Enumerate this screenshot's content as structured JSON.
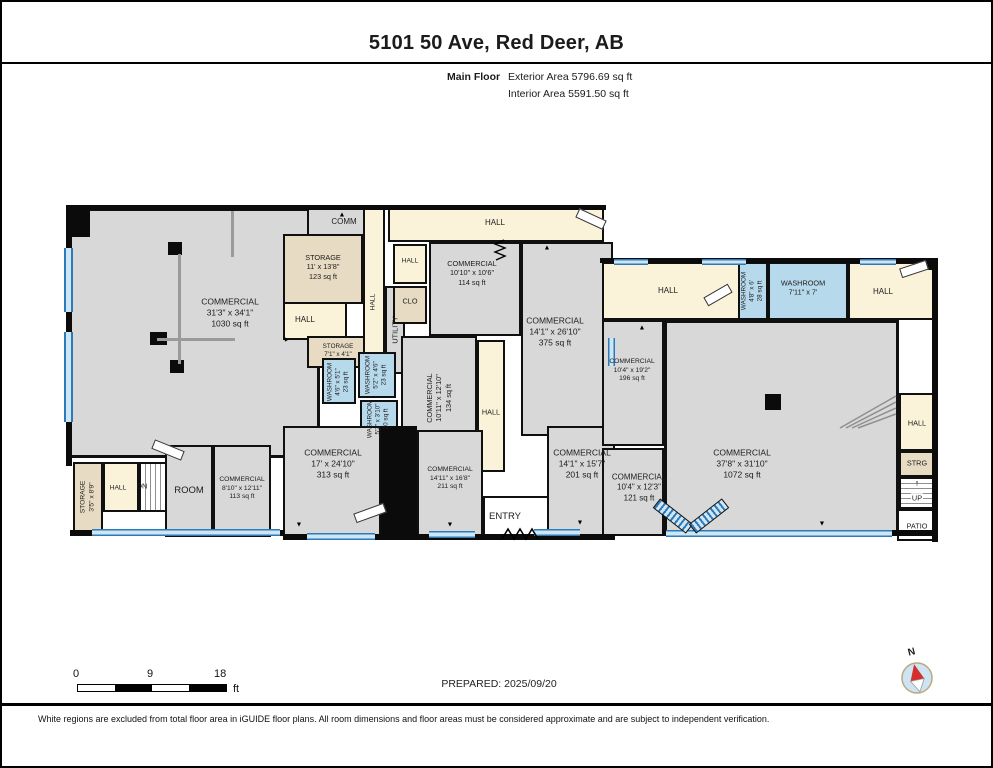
{
  "header": {
    "title": "5101 50 Ave, Red Deer, AB",
    "floor_label": "Main Floor",
    "exterior_area": "Exterior Area 5796.69 sq ft",
    "interior_area": "Interior Area 5591.50 sq ft"
  },
  "rooms": {
    "commercial_1030": {
      "n": "COMMERCIAL",
      "d": "31'3\" x 34'1\"",
      "a": "1030 sq ft"
    },
    "comm": {
      "n": "COMM"
    },
    "storage_123": {
      "n": "STORAGE",
      "d": "11' x 13'8\"",
      "a": "123 sq ft"
    },
    "hall_left": {
      "n": "HALL"
    },
    "storage_small": {
      "n": "STORAGE",
      "d": "7'1\" x 4'1\""
    },
    "hall_vert": {
      "n": "HALL"
    },
    "utility": {
      "n": "UTILITY"
    },
    "hall_top": {
      "n": "HALL"
    },
    "hall_small": {
      "n": "HALL"
    },
    "clo": {
      "n": "CLO"
    },
    "commercial_114": {
      "n": "COMMERCIAL",
      "d": "10'10\" x 10'6\"",
      "a": "114 sq ft"
    },
    "commercial_375": {
      "n": "COMMERCIAL",
      "d": "14'1\" x 26'10\"",
      "a": "375 sq ft"
    },
    "commercial_134": {
      "n": "COMMERCIAL",
      "d": "10'11\" x 12'10\"",
      "a": "134 sq ft"
    },
    "washroom_23a": {
      "n": "WASHROOM",
      "d": "4'6\" x 5'1\"",
      "a": "23 sq ft"
    },
    "washroom_23b": {
      "n": "WASHROOM",
      "d": "5'2\" x 4'6\"",
      "a": "23 sq ft"
    },
    "washroom_20": {
      "n": "WASHROOM",
      "d": "5'2\" x 3'10\"",
      "a": "20 sq ft"
    },
    "hall_mid": {
      "n": "HALL"
    },
    "commercial_313": {
      "n": "COMMERCIAL",
      "d": "17' x 24'10\"",
      "a": "313 sq ft"
    },
    "commercial_211": {
      "n": "COMMERCIAL",
      "d": "14'11\" x 16'8\"",
      "a": "211 sq ft"
    },
    "entry": {
      "n": "ENTRY"
    },
    "commercial_201": {
      "n": "COMMERCIAL",
      "d": "14'1\" x 15'7\"",
      "a": "201 sq ft"
    },
    "storage_strip": {
      "n": "STORAGE",
      "d": "3'5\" x 8'9\""
    },
    "hall_dn": {
      "n": "HALL"
    },
    "dn": {
      "n": "DN"
    },
    "room": {
      "n": "ROOM"
    },
    "commercial_113": {
      "n": "COMMERCIAL",
      "d": "8'10\" x 12'11\"",
      "a": "113 sq ft"
    },
    "hall_rt_left": {
      "n": "HALL"
    },
    "washroom_28": {
      "n": "WASHROOM",
      "d": "4'8\" x 6'",
      "a": "28 sq ft"
    },
    "washroom_7x7": {
      "n": "WASHROOM",
      "d": "7'11\" x 7'"
    },
    "hall_rt_right": {
      "n": "HALL"
    },
    "commercial_196": {
      "n": "COMMERCIAL",
      "d": "10'4\" x 19'2\"",
      "a": "196 sq ft"
    },
    "commercial_121": {
      "n": "COMMERCIAL",
      "d": "10'4\" x 12'3\"",
      "a": "121 sq ft"
    },
    "commercial_1072": {
      "n": "COMMERCIAL",
      "d": "37'8\" x 31'10\"",
      "a": "1072 sq ft"
    },
    "hall_col": {
      "n": "HALL"
    },
    "strg": {
      "n": "STRG"
    },
    "up": {
      "n": "UP"
    },
    "patio": {
      "n": "PATIO"
    }
  },
  "icons": {
    "arrow_up": "▲",
    "arrow_down": "▼",
    "arrow_left": "◄",
    "arrow_right": "►",
    "up_arrow": "↑"
  },
  "footer": {
    "scale": {
      "start": "0",
      "mid": "9",
      "end": "18",
      "unit": "ft"
    },
    "prepared": "PREPARED: 2025/09/20",
    "compass_label": "N",
    "disclaimer": "White regions are excluded from total floor area in iGUIDE floor plans. All room dimensions and floor areas must be considered approximate and are subject to independent verification."
  },
  "colors": {
    "commercial_fill": "#d8d8d8",
    "hall_fill": "#faf3da",
    "storage_fill": "#e7dbc3",
    "washroom_fill": "#b7d9ec",
    "window_blue": "#2e7ab8",
    "wall_black": "#0b0b0b"
  }
}
